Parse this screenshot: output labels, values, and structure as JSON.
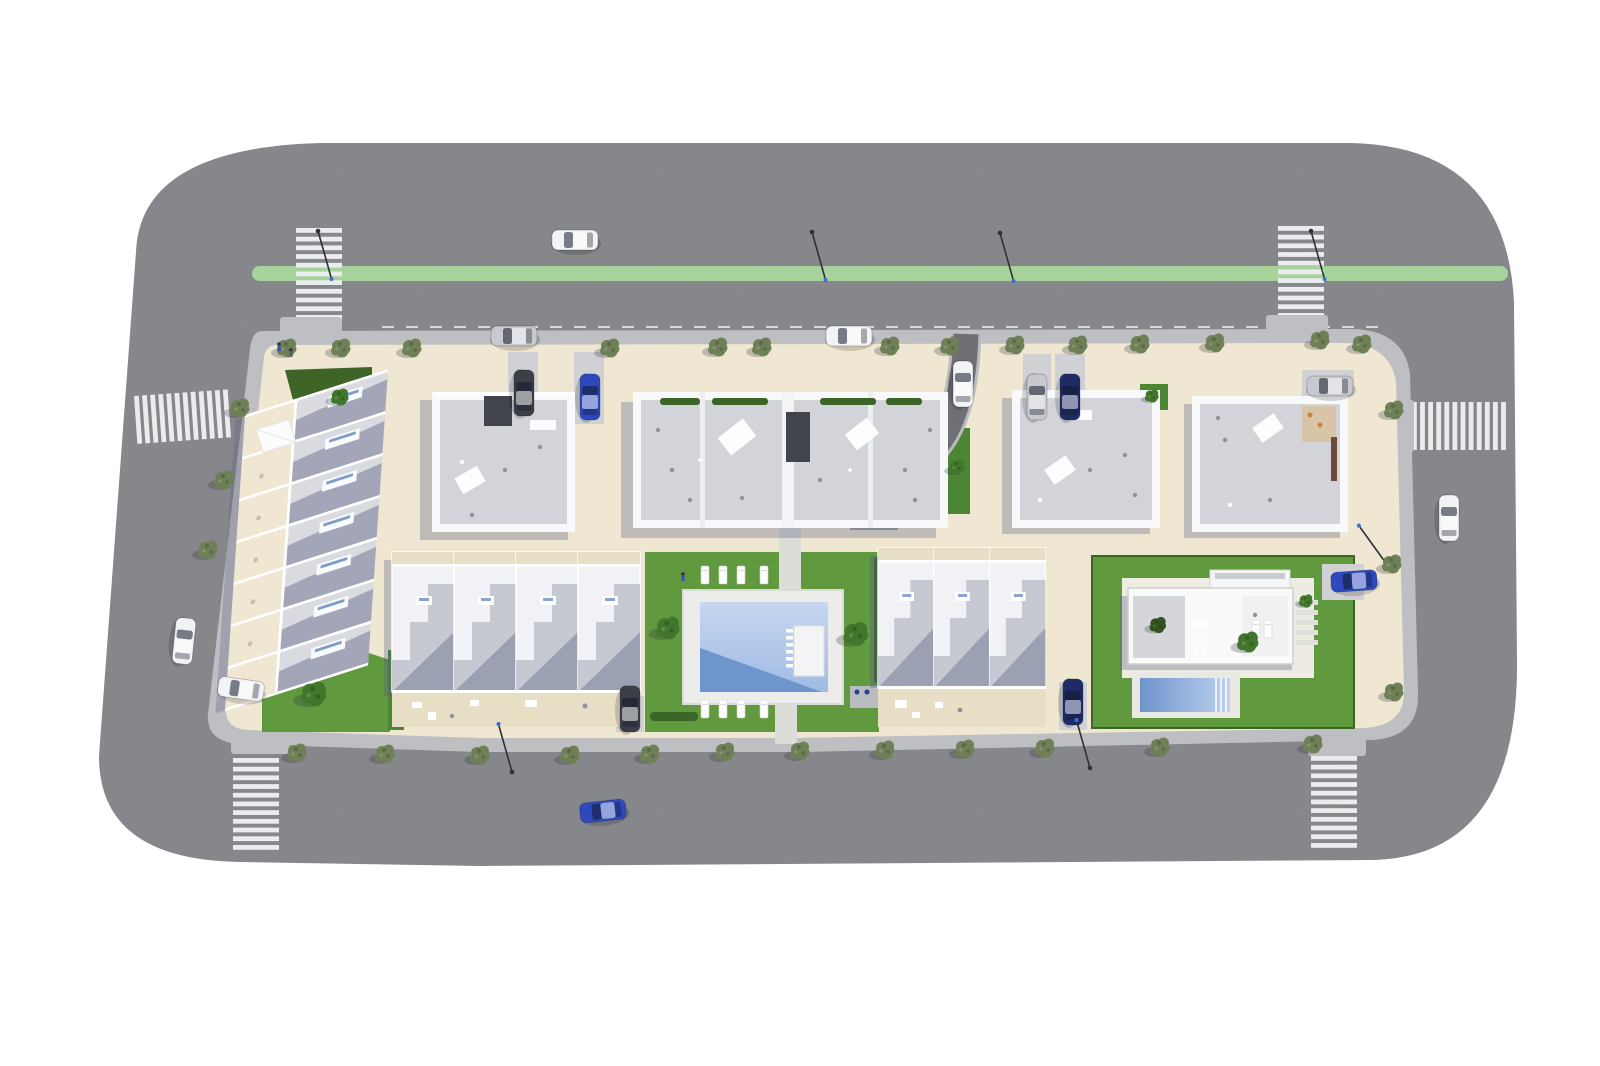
{
  "scene": {
    "label": "aerial-site-plan-residential-development",
    "view": "top-down 3d architectural render, no visible text"
  },
  "colors": {
    "road": "#88898d",
    "bike_lane": "#a7d29c",
    "zebra": "#ebecee",
    "lane_dash": "#d9dade",
    "sidewalk": "#bdbfc2",
    "paving_light": "#cfd1d5",
    "ground": "#efe7d1",
    "ground_shade": "#e7dec6",
    "grass": "#61993f",
    "grass_dark": "#3e6527",
    "grass_mid": "#4c8534",
    "hedge": "#3c6628",
    "pool_deck": "#ececea",
    "water_light": "#c7d6f0",
    "water_mid": "#9fbbe4",
    "water_dark": "#6e95cc",
    "building_white": "#f8f9fb",
    "roof_gray": "#d2d4d9",
    "roof_med": "#c6c9d2",
    "utility_dark": "#41444c",
    "driveway": "#6f7075",
    "lamp": "#2e3036",
    "tree_street": "#6f8057",
    "tree_lush": "#41762c",
    "tree_dark": "#33531f",
    "car_white": "#f2f3f5",
    "car_silver": "#c7c9ce",
    "car_blue": "#2d49bd",
    "car_navy": "#1f2b66",
    "car_dark": "#3c3f46",
    "accent_furniture": "#c9803e"
  },
  "inventory": {
    "buildings": [
      "left-townhouse-row",
      "top-left-apartment",
      "central-apartment",
      "top-right-apartment-1",
      "top-right-apartment-2",
      "bottom-left-townhouses",
      "bottom-right-townhouses",
      "villa"
    ],
    "crosswalks": 6,
    "bike_lane_on_top_road": true,
    "communal_pool": 1,
    "villa_pool": 1,
    "cars": {
      "white": 6,
      "silver": 3,
      "blue": 3,
      "navy": 2,
      "dark_gray": 2
    },
    "street_trees_approx": 32,
    "street_lamps_approx": 7
  }
}
